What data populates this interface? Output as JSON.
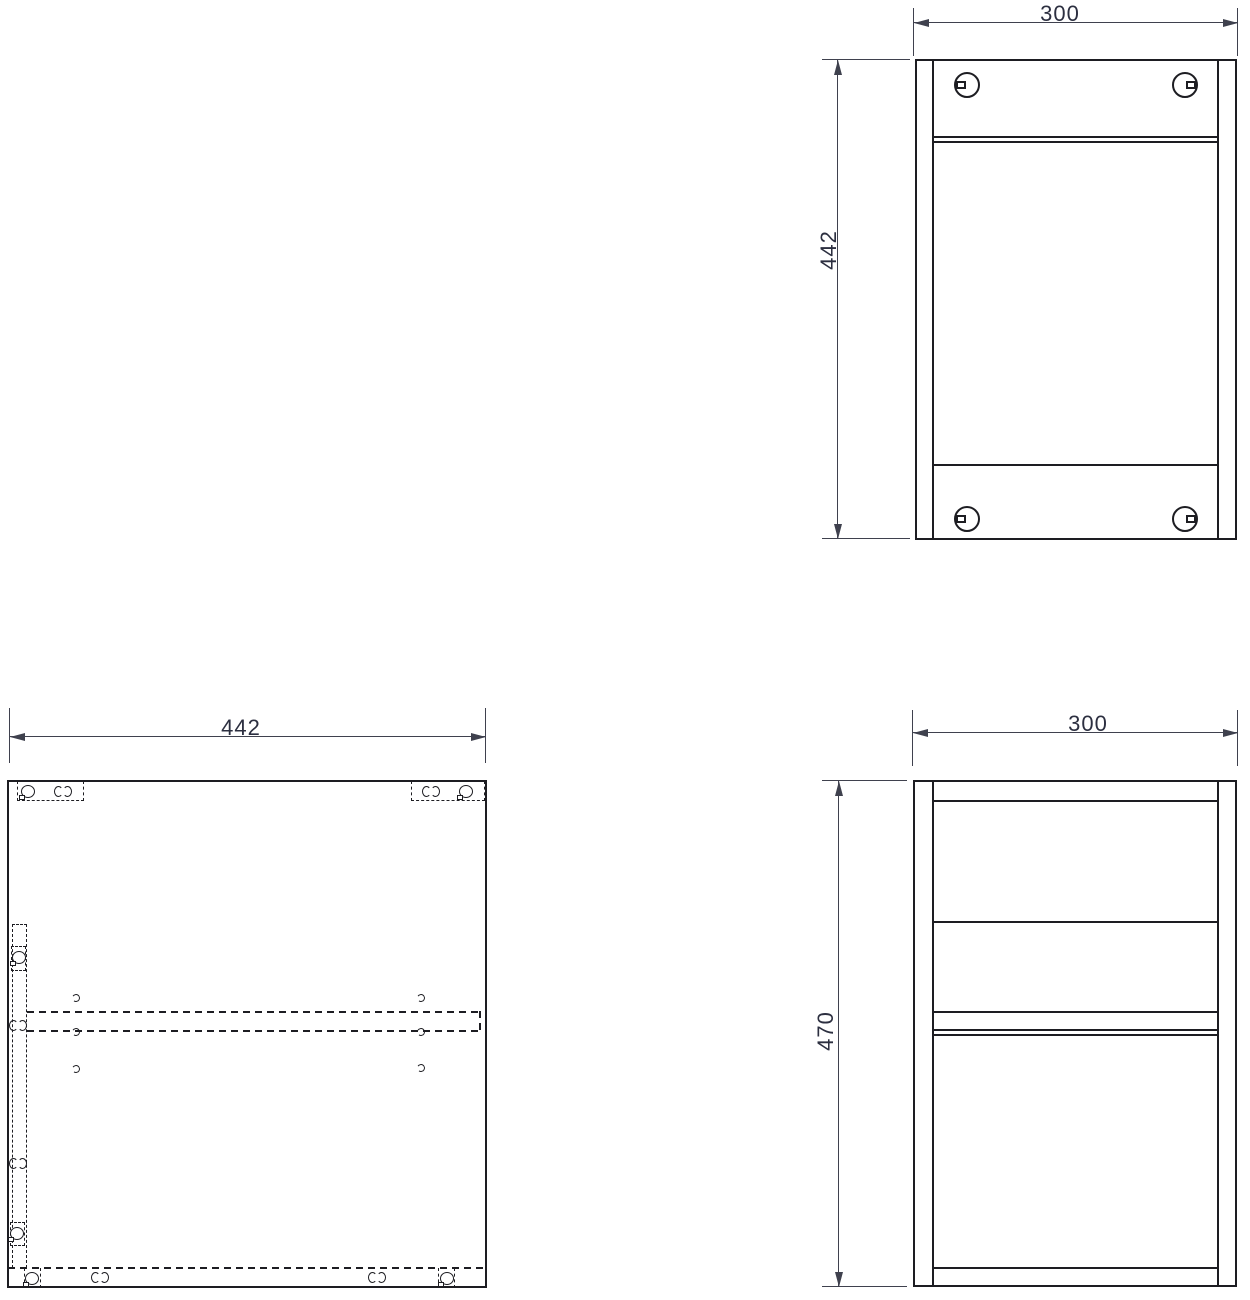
{
  "views": {
    "top_section": {
      "width_label": "300",
      "height_label": "442"
    },
    "side_panel": {
      "width_label": "442"
    },
    "front_elevation": {
      "width_label": "300",
      "height_label": "470"
    }
  },
  "icons": {
    "cam_lock_large": "circle-with-square-tab",
    "cam_lock_small": "circle-with-tab",
    "hole_pair": "two-facing-arcs",
    "pilot_hole": "small-arc"
  },
  "colors": {
    "line": "#1d1d22",
    "dimension": "#3f414e",
    "text": "#2c2f40",
    "background": "#ffffff"
  }
}
